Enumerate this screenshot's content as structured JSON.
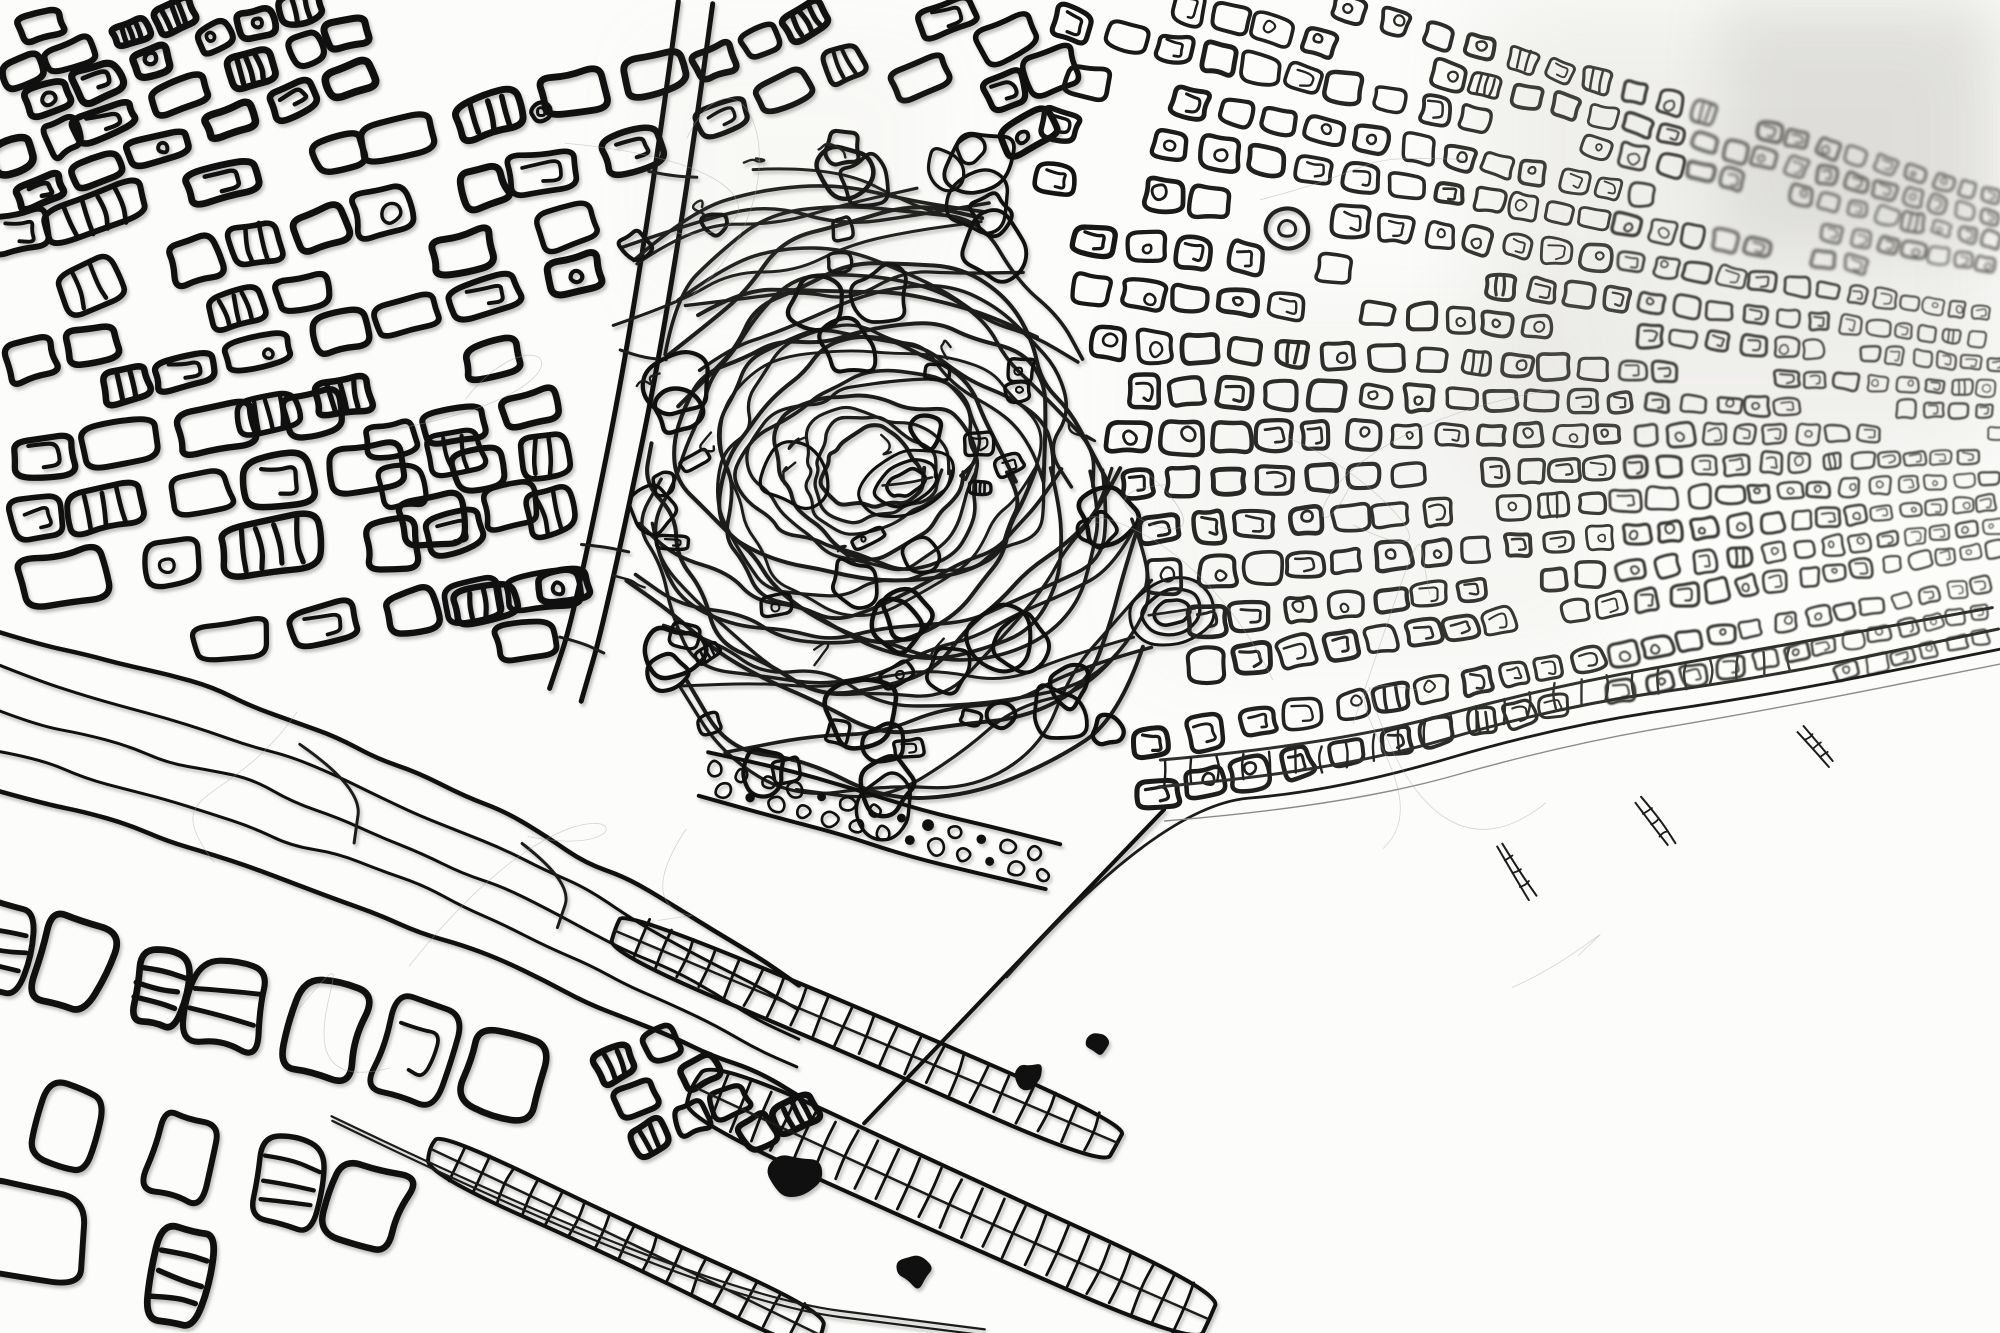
{
  "artwork": {
    "description": "Black 3D-pen wire line drawing of an aerial city map of a Barcelona-like coastal city, photographed at an oblique angle: dense hand-drawn block districts at upper left, a fine receding street grid to the right crossed by white diagonal avenues, an organic hill park with stadium ovals at center, a harbor with ladder-like piers at lower center, and open white sea at lower right.",
    "palette": {
      "paper": "#fcfcfa",
      "ink_near": "#101010",
      "ink_mid": "#1c1c1a",
      "ink_far": "#4a4944",
      "hairline": "#a3a3a0",
      "beach": "#8b8b86"
    }
  },
  "map": {
    "width": 2000,
    "height": 1333,
    "seed": 11,
    "vp": [
      2800,
      430
    ],
    "districts": [
      {
        "name": "northwest-corner",
        "poly": [
          [
            0,
            0
          ],
          [
            360,
            0
          ],
          [
            345,
            150
          ],
          [
            120,
            200
          ],
          [
            0,
            190
          ]
        ],
        "cell": [
          40,
          28
        ],
        "angle": -20,
        "lw": 7,
        "striped": 0.2,
        "inner": 0.18
      },
      {
        "name": "upper-left-blocks",
        "poly": [
          [
            0,
            185
          ],
          [
            345,
            95
          ],
          [
            690,
            15
          ],
          [
            735,
            150
          ],
          [
            610,
            305
          ],
          [
            420,
            395
          ],
          [
            170,
            435
          ],
          [
            0,
            395
          ]
        ],
        "cell": [
          58,
          40
        ],
        "angle": -14,
        "lw": 6.4,
        "striped": 0.22,
        "inner": 0.26
      },
      {
        "name": "west-mid-blocks",
        "poly": [
          [
            0,
            395
          ],
          [
            415,
            405
          ],
          [
            575,
            485
          ],
          [
            545,
            635
          ],
          [
            290,
            668
          ],
          [
            0,
            568
          ]
        ],
        "cell": [
          62,
          44
        ],
        "angle": -9,
        "lw": 6,
        "striped": 0.16,
        "inner": 0.3
      },
      {
        "name": "north-central-blocks",
        "poly": [
          [
            705,
            0
          ],
          [
            1075,
            0
          ],
          [
            1048,
            175
          ],
          [
            862,
            268
          ],
          [
            722,
            180
          ]
        ],
        "cell": [
          46,
          33
        ],
        "angle": -24,
        "lw": 6,
        "striped": 0.12,
        "inner": 0.3
      },
      {
        "name": "mid-slope-blocks",
        "poly": [
          [
            358,
            432
          ],
          [
            558,
            358
          ],
          [
            650,
            478
          ],
          [
            572,
            652
          ],
          [
            376,
            608
          ]
        ],
        "cell": [
          52,
          38
        ],
        "angle": -12,
        "lw": 6,
        "striped": 0.18,
        "inner": 0.24
      },
      {
        "name": "southwest-industrial",
        "poly": [
          [
            0,
            800
          ],
          [
            300,
            882
          ],
          [
            520,
            1002
          ],
          [
            558,
            1122
          ],
          [
            378,
            1242
          ],
          [
            118,
            1333
          ],
          [
            0,
            1333
          ]
        ],
        "cell": [
          64,
          92
        ],
        "angle": 14,
        "lw": 6.4,
        "striped": 0.52,
        "inner": 0.1
      },
      {
        "name": "harbor-blocks",
        "poly": [
          [
            572,
            962
          ],
          [
            792,
            998
          ],
          [
            822,
            1122
          ],
          [
            640,
            1162
          ]
        ],
        "cell": [
          36,
          27
        ],
        "angle": -24,
        "lw": 6,
        "striped": 0.34,
        "inner": 0.2
      }
    ],
    "street_carves": [
      {
        "pts": [
          [
            0,
            215
          ],
          [
            480,
            98
          ]
        ],
        "w": 14
      },
      {
        "pts": [
          [
            148,
            432
          ],
          [
            618,
            302
          ]
        ],
        "w": 12
      },
      {
        "pts": [
          [
            756,
            62
          ],
          [
            1042,
            152
          ]
        ],
        "w": 12
      },
      {
        "pts": [
          [
            0,
            305
          ],
          [
            340,
            345
          ]
        ],
        "w": 10
      }
    ],
    "avenues": [
      {
        "name": "avinguda-meridiana",
        "pts": [
          [
            1152,
            0
          ],
          [
            1128,
            118
          ],
          [
            1108,
            216
          ]
        ],
        "w": 24
      },
      {
        "name": "west-arm",
        "pts": [
          [
            1022,
            256
          ],
          [
            1106,
            224
          ],
          [
            1266,
            227
          ]
        ],
        "w": 18
      },
      {
        "name": "gran-via-east",
        "pts": [
          [
            1306,
            238
          ],
          [
            1650,
            352
          ],
          [
            2000,
            452
          ]
        ],
        "w": 17
      },
      {
        "name": "avinguda-diagonal",
        "pts": [
          [
            1268,
            0
          ],
          [
            1620,
            176
          ],
          [
            2000,
            300
          ]
        ],
        "w": 15
      },
      {
        "name": "carrer-marina",
        "pts": [
          [
            1330,
            300
          ],
          [
            1592,
            700
          ]
        ],
        "w": 14
      },
      {
        "name": "far-east-avenue",
        "pts": [
          [
            1702,
            62
          ],
          [
            1882,
            432
          ]
        ],
        "w": 10
      }
    ],
    "central_avenue": {
      "name": "central-avenue",
      "pts": [
        [
          697,
          0
        ],
        [
          656,
          292
        ],
        [
          592,
          612
        ],
        [
          566,
          692
        ]
      ],
      "w": 34,
      "lw": 5,
      "ticks": 4
    },
    "highway_band": {
      "name": "southwest-highway",
      "top": [
        [
          0,
          628
        ],
        [
          250,
          702
        ],
        [
          520,
          818
        ],
        [
          830,
          1002
        ]
      ],
      "bottom": [
        [
          0,
          788
        ],
        [
          250,
          864
        ],
        [
          520,
          968
        ],
        [
          860,
          1122
        ]
      ],
      "lanes": 3,
      "lw_edge": 4.5,
      "lw_lane": 3
    },
    "grid": {
      "name": "eixample-grid",
      "poly": [
        [
          1052,
          0
        ],
        [
          2000,
          0
        ],
        [
          2000,
          652
        ],
        [
          1770,
          694
        ],
        [
          1430,
          778
        ],
        [
          1162,
          806
        ],
        [
          1070,
          640
        ],
        [
          1032,
          340
        ],
        [
          1028,
          212
        ]
      ],
      "x_near": 1040,
      "cell_near": 40,
      "row_step": 50,
      "lw_near": 5,
      "lw_far": 2.1,
      "inner": 0.6,
      "blur_x": 1620,
      "blur2_x": 1700,
      "blur2_y": 270
    },
    "hill": {
      "name": "montjuic-hill",
      "poly": [
        [
          660,
          132
        ],
        [
          866,
          118
        ],
        [
          985,
          152
        ],
        [
          1065,
          312
        ],
        [
          1150,
          532
        ],
        [
          1185,
          702
        ],
        [
          1052,
          806
        ],
        [
          846,
          826
        ],
        [
          700,
          766
        ],
        [
          618,
          562
        ],
        [
          600,
          302
        ]
      ],
      "center": [
        872,
        470
      ],
      "contours": 24,
      "blobs": 40,
      "cells": 20,
      "squiggles": 14,
      "lw": 3.6
    },
    "stadiums": [
      {
        "c": [
          906,
          483
        ],
        "rx": 50,
        "ry": 30,
        "rot": -24,
        "rings": 3
      },
      {
        "c": [
          1172,
          612
        ],
        "rx": 44,
        "ry": 33,
        "rot": -12,
        "rings": 3
      }
    ],
    "roundabouts": [
      {
        "c": [
          1287,
          229
        ],
        "r": 21
      },
      {
        "c": [
          541,
          112
        ],
        "r": 10
      }
    ],
    "tree_boulevard": {
      "a": [
        706,
        776
      ],
      "b": [
        1052,
        868
      ],
      "w": 48,
      "circles": 26
    },
    "quays": [
      {
        "a": [
          618,
          930
        ],
        "b": [
          1115,
          1142
        ],
        "w": 46,
        "rungs": 22
      },
      {
        "a": [
          698,
          1088
        ],
        "b": [
          1205,
          1318
        ],
        "w": 60,
        "rungs": 24
      },
      {
        "a": [
          432,
          1152
        ],
        "b": [
          820,
          1333
        ],
        "w": 42,
        "rungs": 16
      }
    ],
    "breakwater": {
      "pts": [
        [
          330,
          1118
        ],
        [
          700,
          1295
        ],
        [
          985,
          1333
        ]
      ]
    },
    "port_edge": {
      "pts": [
        [
          860,
          1120
        ],
        [
          1005,
          975
        ],
        [
          1162,
          806
        ]
      ]
    },
    "sea_boundary": {
      "pts": [
        [
          620,
          1333
        ],
        [
          860,
          1120
        ],
        [
          1005,
          975
        ],
        [
          1162,
          806
        ],
        [
          1340,
          790
        ],
        [
          1560,
          728
        ],
        [
          1770,
          695
        ],
        [
          2000,
          650
        ]
      ]
    },
    "coast": {
      "ladder_from": 1165,
      "ladder_to": 1790,
      "off_inland1": 20,
      "off_inland2": 44,
      "rung_step": 26,
      "beach_offset": 16
    },
    "groynes": [
      [
        1500,
        845,
        62,
        58
      ],
      [
        1640,
        800,
        54,
        55
      ],
      [
        1802,
        728,
        46,
        50
      ]
    ],
    "ink_blobs": [
      [
        795,
        1180,
        24
      ],
      [
        915,
        1268,
        18
      ],
      [
        1028,
        1076,
        16
      ],
      [
        1098,
        1042,
        13
      ]
    ],
    "hairs": 16,
    "washes": [
      [
        1480,
        0,
        520,
        460,
        0.13,
        "#98968f",
        46
      ],
      [
        1720,
        0,
        280,
        250,
        0.16,
        "#8e8c85",
        30
      ],
      [
        1150,
        300,
        460,
        360,
        0.07,
        "#a9a79f",
        44
      ],
      [
        640,
        40,
        300,
        260,
        0.05,
        "#b9b7af",
        40
      ]
    ]
  }
}
